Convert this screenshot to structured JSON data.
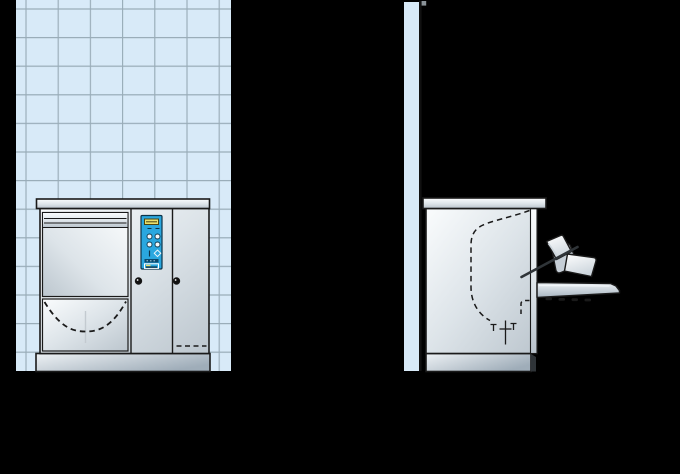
{
  "canvas": {
    "width": 680,
    "height": 474,
    "background": "#000000"
  },
  "colors": {
    "background": "#000000",
    "tile": "#d8eaf8",
    "grout": "#93a5b2",
    "line": "#1a1a1a",
    "metal_light": "#fafcfd",
    "metal_mid": "#dde4e9",
    "metal_dark": "#bcc6ce",
    "counter_light": "#fbfdfe",
    "counter_dark": "#b9c3cc",
    "plinth_light": "#eef2f5",
    "plinth_dark": "#9fadb9",
    "panel_blue": "#2aa7df",
    "panel_border": "#0c3349",
    "display_yellow": "#e9e06d",
    "display_border": "#4a4410",
    "brand_dark": "#0b4a6e",
    "badge_border": "#ffffff",
    "knob": "#111111",
    "rod": "#2f3438",
    "tray": "#ffffff",
    "tray_shade": "#cdd6dd",
    "rack": "#c5ced6",
    "flap_light": "#eef2f6",
    "flap_dark": "#a9b6c1",
    "wall_edge": "#111111",
    "notch": "#8a9298",
    "highlight": "#f2f6f9",
    "faint_line": "#c3cad0"
  },
  "views": {
    "front": {
      "id": "front-view"
    },
    "side": {
      "id": "side-view"
    }
  },
  "parts": {
    "front_view": [
      "tiled-wall",
      "worktop",
      "machine-body",
      "hood-door",
      "vent-lines",
      "tank-panel",
      "tank-dashed-outline",
      "control-panel",
      "lcd-display",
      "program-buttons",
      "selector-mark",
      "diamond-mark",
      "brand-label",
      "logo-badge",
      "door-knob-left",
      "door-knob-right",
      "service-panel-dashed-line",
      "plinth"
    ],
    "side_view": [
      "wall-strip",
      "wall-edge-line",
      "worktop",
      "machine-body",
      "door-edge-strip",
      "wash-chamber-dashed-outline",
      "chamber-door-bracket",
      "drain-symbol",
      "open-door-flap",
      "door-rollers",
      "dish-rack",
      "tray-front",
      "tray-back",
      "handle-rod",
      "plinth",
      "plinth-side-shadow"
    ]
  }
}
